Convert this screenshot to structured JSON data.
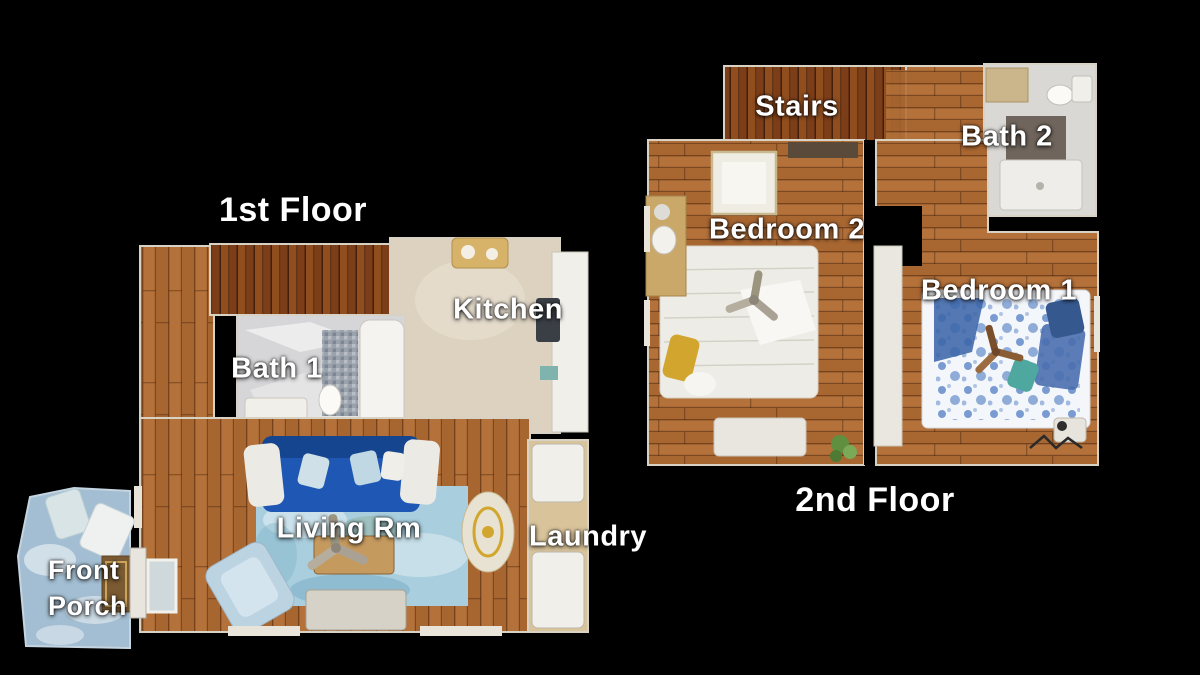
{
  "floors": {
    "first": {
      "title": "1st Floor",
      "rooms": {
        "kitchen": "Kitchen",
        "bath1": "Bath 1",
        "living": "Living Rm",
        "laundry": "Laundry",
        "front_porch": {
          "line1": "Front",
          "line2": "Porch"
        }
      }
    },
    "second": {
      "title": "2nd Floor",
      "rooms": {
        "stairs": "Stairs",
        "bath2": "Bath 2",
        "bedroom2": "Bedroom 2",
        "bedroom1": "Bedroom 1"
      }
    }
  },
  "colors": {
    "background": "#000000",
    "label_text": "#ffffff",
    "wood_light": "#b4713a",
    "wood_mid": "#9c5c28",
    "wood_dark": "#7c3e18",
    "wood_dark_hi": "#975221",
    "kitchen_tile": "#ddd2c0",
    "bath_marble": "#d6d6d8",
    "shower_tile": "#9aa2ac",
    "sofa_blue": "#1f57b5",
    "rug_blue": "#a9cede",
    "porch_blue": "#a3bed2",
    "bed1_floral_blue": "#6d92cc",
    "bed2_ivory": "#edece6",
    "pillow_yellow": "#d2a62e",
    "laundry_tan": "#d8c39a",
    "fixture_white": "#f0efe9",
    "wall_edge": "#d8d2c4",
    "plant_green": "#5f8f3f"
  }
}
